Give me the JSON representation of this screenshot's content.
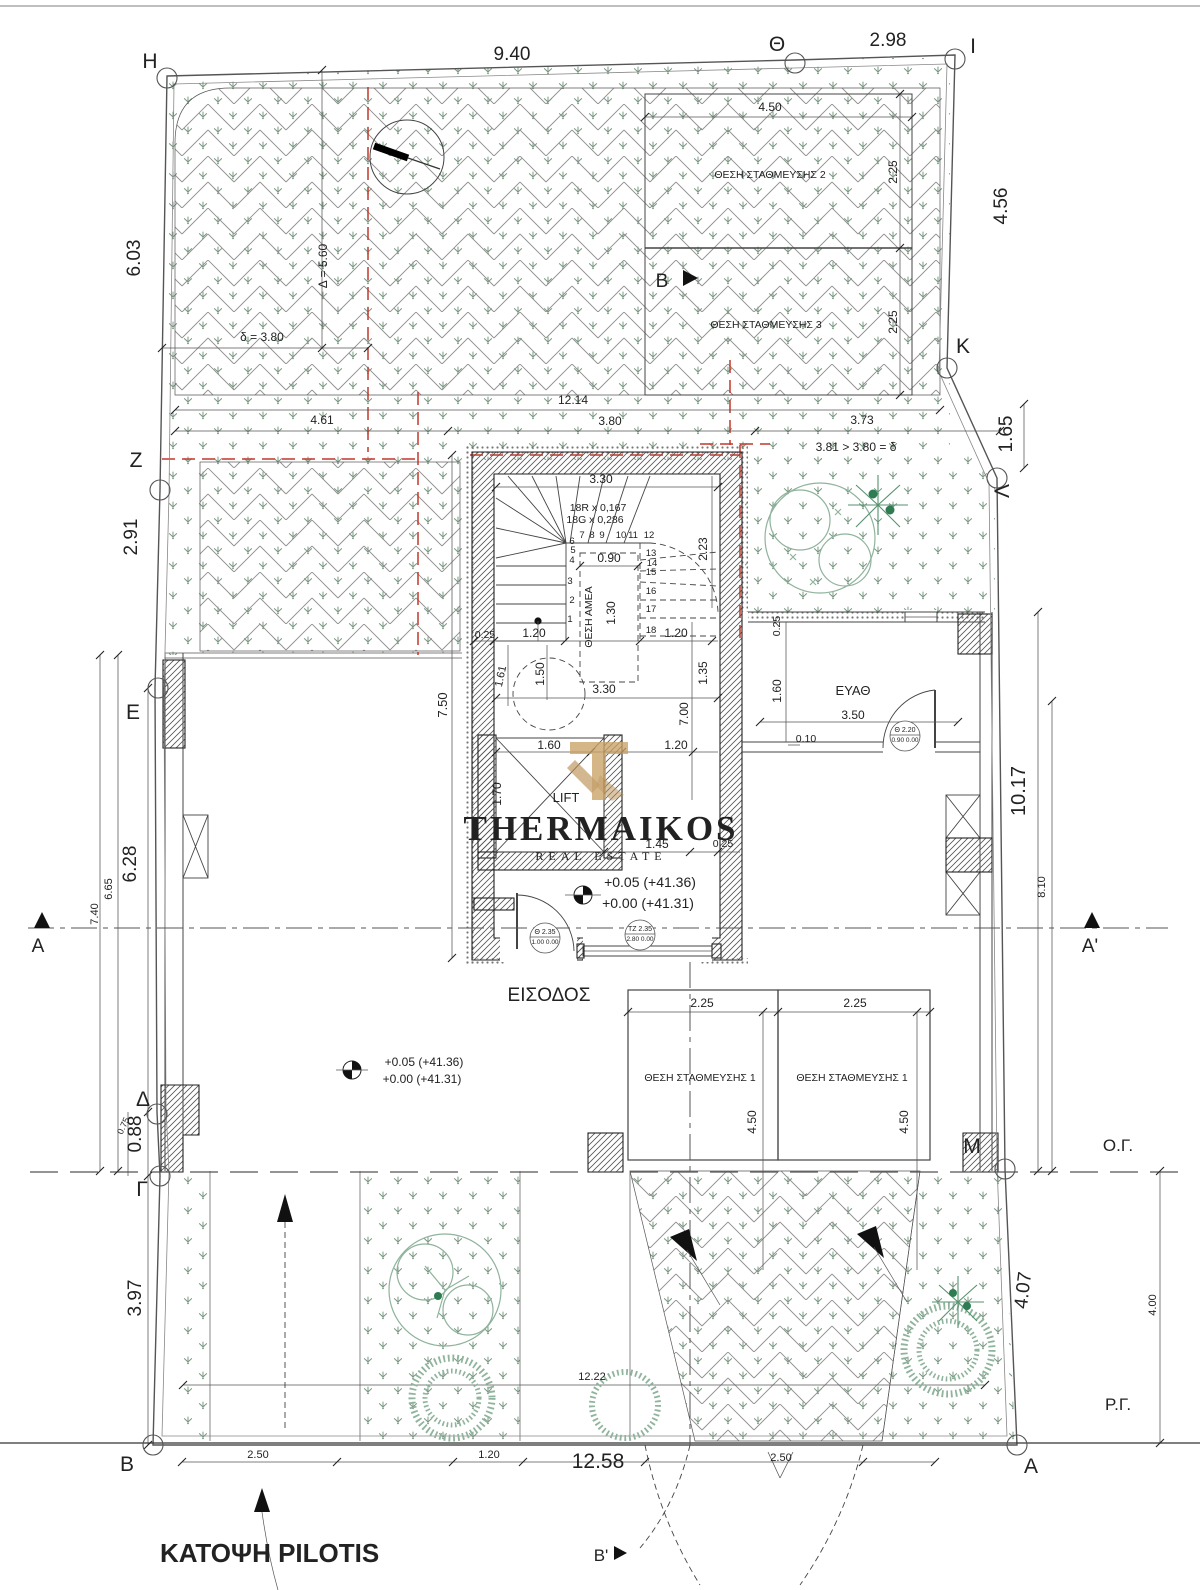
{
  "drawing": {
    "title": "ΚΑΤΟΨΗ PILOTIS",
    "entrance_label": "ΕΙΣΟΔΟΣ",
    "utility_room_label": "ΕΥΑΘ",
    "lift_label": "LIFT",
    "disabled_spot_label": "ΘΕΣΗ ΑΜΕΑ",
    "stair_note_risers": "18R x 0,167",
    "stair_note_goings": "18G x 0,286",
    "levels": [
      "+0.05 (+41.36)",
      "+0.00 (+41.31)"
    ],
    "building_line_label": "Ο.Γ.",
    "street_line_label": "Ρ.Γ."
  },
  "watermark": {
    "name": "THERMAIKOS",
    "tagline": "REAL ESTATE"
  },
  "colors": {
    "red": "#c0392b",
    "grass": "#76957f",
    "hatch": "#8f8f8f",
    "tree": "#8fb39c",
    "tree_dark": "#2e7d52",
    "fir": "#57916f",
    "gold": "#c9a063",
    "gold2": "#b98f53",
    "wm": "#8c8c8c",
    "wm2": "#ababab"
  },
  "markers": [
    {
      "id": "H",
      "x": 167,
      "y": 78
    },
    {
      "id": "Theta",
      "x": 795,
      "y": 63
    },
    {
      "id": "I",
      "x": 955,
      "y": 59
    },
    {
      "id": "K",
      "x": 947,
      "y": 368
    },
    {
      "id": "Lambda",
      "x": 997,
      "y": 478
    },
    {
      "id": "Z",
      "x": 160,
      "y": 490
    },
    {
      "id": "E",
      "x": 158,
      "y": 688
    },
    {
      "id": "Delta",
      "x": 157,
      "y": 1114
    },
    {
      "id": "Gamma",
      "x": 160,
      "y": 1176
    },
    {
      "id": "B",
      "x": 153,
      "y": 1445
    },
    {
      "id": "M",
      "x": 1005,
      "y": 1169
    },
    {
      "id": "A",
      "x": 1017,
      "y": 1445
    }
  ],
  "texts": [
    {
      "t": "H",
      "x": 150,
      "y": 68,
      "s": 21,
      "n": "marker-H"
    },
    {
      "t": "Θ",
      "x": 777,
      "y": 51,
      "s": 21,
      "n": "marker-theta"
    },
    {
      "t": "I",
      "x": 973,
      "y": 53,
      "s": 21,
      "n": "marker-I"
    },
    {
      "t": "K",
      "x": 963,
      "y": 353,
      "s": 21,
      "n": "marker-K"
    },
    {
      "t": "Λ",
      "x": 1009,
      "y": 491,
      "s": 21,
      "r": -90,
      "n": "marker-lambda"
    },
    {
      "t": "Z",
      "x": 136,
      "y": 467,
      "s": 21,
      "n": "marker-Z"
    },
    {
      "t": "E",
      "x": 133,
      "y": 719,
      "s": 21,
      "n": "marker-E"
    },
    {
      "t": "Δ",
      "x": 143,
      "y": 1106,
      "s": 21,
      "n": "marker-delta"
    },
    {
      "t": "Γ",
      "x": 142,
      "y": 1196,
      "s": 21,
      "n": "marker-gamma"
    },
    {
      "t": "B",
      "x": 127,
      "y": 1471,
      "s": 21,
      "n": "marker-B"
    },
    {
      "t": "M",
      "x": 972,
      "y": 1153,
      "s": 21,
      "n": "marker-M"
    },
    {
      "t": "A",
      "x": 1031,
      "y": 1473,
      "s": 21,
      "n": "marker-A"
    },
    {
      "t": "A",
      "x": 38,
      "y": 952,
      "s": 19,
      "n": "section-label-A"
    },
    {
      "t": "A'",
      "x": 1090,
      "y": 952,
      "s": 19,
      "n": "section-label-A2"
    },
    {
      "t": "B",
      "x": 662,
      "y": 287,
      "s": 19,
      "n": "section-label-B"
    },
    {
      "t": "Β'",
      "x": 601,
      "y": 1561,
      "s": 17,
      "n": "section-label-B2"
    },
    {
      "t": "9.40",
      "x": 512,
      "y": 60,
      "s": 19
    },
    {
      "t": "2.98",
      "x": 888,
      "y": 46,
      "s": 19
    },
    {
      "t": "6.03",
      "x": 140,
      "y": 258,
      "s": 19,
      "r": -90
    },
    {
      "t": "4.56",
      "x": 1007,
      "y": 206,
      "s": 19,
      "r": -90
    },
    {
      "t": "1.65",
      "x": 1012,
      "y": 434,
      "s": 19,
      "r": -90
    },
    {
      "t": "2.91",
      "x": 137,
      "y": 537,
      "s": 19,
      "r": -90
    },
    {
      "t": "6.28",
      "x": 136,
      "y": 864,
      "s": 19,
      "r": -90
    },
    {
      "t": "10.17",
      "x": 1025,
      "y": 791,
      "s": 20,
      "r": -90
    },
    {
      "t": "0.88",
      "x": 141,
      "y": 1134,
      "s": 19,
      "r": -90
    },
    {
      "t": "3.97",
      "x": 141,
      "y": 1298,
      "s": 19,
      "r": -90
    },
    {
      "t": "4.07",
      "x": 1029,
      "y": 1291,
      "s": 19,
      "r": -83
    },
    {
      "t": "12.58",
      "x": 598,
      "y": 1468,
      "s": 21
    },
    {
      "t": "6.65",
      "x": 112,
      "y": 889,
      "s": 11,
      "r": -90
    },
    {
      "t": "7.40",
      "x": 98,
      "y": 914,
      "s": 11,
      "r": -90
    },
    {
      "t": "0.75",
      "x": 126,
      "y": 1127,
      "s": 9,
      "r": -65
    },
    {
      "t": "8.10",
      "x": 1045,
      "y": 887,
      "s": 11,
      "r": -90
    },
    {
      "t": "4.00",
      "x": 1156,
      "y": 1305,
      "s": 11,
      "r": -90
    },
    {
      "t": "Ο.Γ.",
      "x": 1118,
      "y": 1151,
      "s": 17,
      "n": "building-line-label"
    },
    {
      "t": "Ρ.Γ.",
      "x": 1118,
      "y": 1410,
      "s": 17,
      "n": "street-line-label"
    },
    {
      "t": "4.50",
      "x": 770,
      "y": 111,
      "s": 12
    },
    {
      "t": "2.25",
      "x": 897,
      "y": 172,
      "s": 12,
      "r": -90
    },
    {
      "t": "2.25",
      "x": 897,
      "y": 322,
      "s": 12,
      "r": -90
    },
    {
      "t": "ΘΕΣΗ ΣΤΑΘΜΕΥΣΗΣ 2",
      "x": 770,
      "y": 178,
      "s": 10.5,
      "n": "parking-2-label"
    },
    {
      "t": "ΘΕΣΗ ΣΤΑΘΜΕΥΣΗΣ 3",
      "x": 766,
      "y": 328,
      "s": 10.5,
      "n": "parking-3-label"
    },
    {
      "t": "δ = 3.80",
      "x": 262,
      "y": 341,
      "s": 12
    },
    {
      "t": "Δ = 5.60",
      "x": 327,
      "y": 266,
      "s": 12,
      "r": -90
    },
    {
      "t": "12.14",
      "x": 573,
      "y": 404,
      "s": 12
    },
    {
      "t": "4.61",
      "x": 322,
      "y": 424,
      "s": 12
    },
    {
      "t": "3.80",
      "x": 610,
      "y": 425,
      "s": 12
    },
    {
      "t": "3.73",
      "x": 862,
      "y": 424,
      "s": 12
    },
    {
      "t": "3.81 > 3.80 = δ",
      "x": 856,
      "y": 451,
      "s": 12
    },
    {
      "t": "3.30",
      "x": 601,
      "y": 483,
      "s": 12
    },
    {
      "t": "18R x 0,167",
      "x": 598,
      "y": 511,
      "s": 10.5,
      "n": "stair-note-risers"
    },
    {
      "t": "18G x 0,286",
      "x": 595,
      "y": 523,
      "s": 10.5,
      "n": "stair-note-goings"
    },
    {
      "t": "0.90",
      "x": 609,
      "y": 562,
      "s": 12
    },
    {
      "t": "ΘΕΣΗ ΑΜΕΑ",
      "x": 592,
      "y": 617,
      "s": 10.5,
      "r": -90,
      "n": "disabled-spot-label"
    },
    {
      "t": "1.30",
      "x": 615,
      "y": 613,
      "s": 12,
      "r": -90
    },
    {
      "t": "2.23",
      "x": 707,
      "y": 549,
      "s": 12,
      "r": -90
    },
    {
      "t": "0.25",
      "x": 485,
      "y": 638,
      "s": 10.5
    },
    {
      "t": "1.20",
      "x": 534,
      "y": 637,
      "s": 12
    },
    {
      "t": "1.20",
      "x": 676,
      "y": 637,
      "s": 12
    },
    {
      "t": "1.61",
      "x": 504,
      "y": 677,
      "s": 11,
      "r": -78
    },
    {
      "t": "1.50",
      "x": 544,
      "y": 674,
      "s": 12,
      "r": -90
    },
    {
      "t": "3.30",
      "x": 604,
      "y": 693,
      "s": 12
    },
    {
      "t": "7.00",
      "x": 688,
      "y": 714,
      "s": 12,
      "r": -90
    },
    {
      "t": "1.35",
      "x": 707,
      "y": 673,
      "s": 12,
      "r": -90
    },
    {
      "t": "7.50",
      "x": 447,
      "y": 705,
      "s": 13,
      "r": -90
    },
    {
      "t": "1",
      "x": 570,
      "y": 622,
      "s": 9.5
    },
    {
      "t": "2",
      "x": 572,
      "y": 603,
      "s": 9.5
    },
    {
      "t": "3",
      "x": 570,
      "y": 584,
      "s": 9.5
    },
    {
      "t": "4",
      "x": 572,
      "y": 563,
      "s": 9.5
    },
    {
      "t": "5",
      "x": 573,
      "y": 553,
      "s": 9.5
    },
    {
      "t": "6",
      "x": 572,
      "y": 544,
      "s": 9.5
    },
    {
      "t": "7",
      "x": 582,
      "y": 538,
      "s": 9.5
    },
    {
      "t": "8",
      "x": 592,
      "y": 538,
      "s": 9.5
    },
    {
      "t": "9",
      "x": 602,
      "y": 538,
      "s": 9.5
    },
    {
      "t": "10",
      "x": 621,
      "y": 538,
      "s": 9.5
    },
    {
      "t": "11",
      "x": 633,
      "y": 538,
      "s": 9.5
    },
    {
      "t": "12",
      "x": 649,
      "y": 538,
      "s": 9.5
    },
    {
      "t": "13",
      "x": 651,
      "y": 556,
      "s": 9.5
    },
    {
      "t": "14",
      "x": 652,
      "y": 566,
      "s": 9.5
    },
    {
      "t": "15",
      "x": 651,
      "y": 575,
      "s": 9.5
    },
    {
      "t": "16",
      "x": 651,
      "y": 594,
      "s": 9.5
    },
    {
      "t": "17",
      "x": 651,
      "y": 612,
      "s": 9.5
    },
    {
      "t": "18",
      "x": 651,
      "y": 633,
      "s": 9.5
    },
    {
      "t": "1.60",
      "x": 549,
      "y": 749,
      "s": 12
    },
    {
      "t": "1.20",
      "x": 676,
      "y": 749,
      "s": 12
    },
    {
      "t": "1.70",
      "x": 501,
      "y": 794,
      "s": 12,
      "r": -90
    },
    {
      "t": "LIFT",
      "x": 566,
      "y": 802,
      "s": 13,
      "n": "lift-label"
    },
    {
      "t": "1.45",
      "x": 657,
      "y": 848,
      "s": 12
    },
    {
      "t": "0.25",
      "x": 723,
      "y": 847,
      "s": 10.5
    },
    {
      "t": "+0.05 (+41.36)",
      "x": 650,
      "y": 887,
      "s": 14,
      "n": "level-upper"
    },
    {
      "t": "+0.00 (+41.31)",
      "x": 648,
      "y": 908,
      "s": 14,
      "n": "level-lower"
    },
    {
      "t": "ΕΙΣΟΔΟΣ",
      "x": 549,
      "y": 1001,
      "s": 19,
      "n": "entrance-label"
    },
    {
      "t": "0.25",
      "x": 780,
      "y": 626,
      "s": 10.5,
      "r": -90
    },
    {
      "t": "1.60",
      "x": 781,
      "y": 691,
      "s": 12,
      "r": -90
    },
    {
      "t": "ΕΥΑΘ",
      "x": 853,
      "y": 695,
      "s": 13,
      "n": "utility-room-label"
    },
    {
      "t": "3.50",
      "x": 853,
      "y": 719,
      "s": 12
    },
    {
      "t": "0.10",
      "x": 806,
      "y": 742,
      "s": 10.5
    },
    {
      "t": "+0.05 (+41.36)",
      "x": 424,
      "y": 1066,
      "s": 12,
      "n": "level-upper-2"
    },
    {
      "t": "+0.00 (+41.31)",
      "x": 422,
      "y": 1083,
      "s": 12,
      "n": "level-lower-2"
    },
    {
      "t": "2.25",
      "x": 702,
      "y": 1007,
      "s": 12
    },
    {
      "t": "2.25",
      "x": 855,
      "y": 1007,
      "s": 12
    },
    {
      "t": "ΘΕΣΗ ΣΤΑΘΜΕΥΣΗΣ 1",
      "x": 700,
      "y": 1081,
      "s": 10.5,
      "n": "parking-1a-label"
    },
    {
      "t": "ΘΕΣΗ ΣΤΑΘΜΕΥΣΗΣ 1",
      "x": 852,
      "y": 1081,
      "s": 10.5,
      "n": "parking-1b-label"
    },
    {
      "t": "4.50",
      "x": 756,
      "y": 1122,
      "s": 12,
      "r": -90
    },
    {
      "t": "4.50",
      "x": 908,
      "y": 1122,
      "s": 12,
      "r": -90
    },
    {
      "t": "12.22",
      "x": 592,
      "y": 1380,
      "s": 11
    },
    {
      "t": "2.50",
      "x": 258,
      "y": 1458,
      "s": 11
    },
    {
      "t": "1.20",
      "x": 489,
      "y": 1458,
      "s": 11
    },
    {
      "t": "2.50",
      "x": 781,
      "y": 1461,
      "s": 11
    },
    {
      "t": "ΚΑΤΟΨΗ PILOTIS",
      "x": 160,
      "y": 1562,
      "s": 26,
      "w": 700,
      "a": "start",
      "n": "drawing-title"
    },
    {
      "t": "Θ  2.35",
      "x": 545,
      "y": 934,
      "s": 7,
      "n": "door-tag-1"
    },
    {
      "t": "1.00 0.00",
      "x": 545,
      "y": 944,
      "s": 6.5,
      "n": "door-tag-1b"
    },
    {
      "t": "ΤΖ 2.35",
      "x": 640,
      "y": 931,
      "s": 7,
      "n": "door-tag-2"
    },
    {
      "t": "2.80 0.00",
      "x": 640,
      "y": 941,
      "s": 6.5,
      "n": "door-tag-2b"
    },
    {
      "t": "Θ  2.20",
      "x": 905,
      "y": 732,
      "s": 7,
      "n": "door-tag-3"
    },
    {
      "t": "0.90 0.00",
      "x": 905,
      "y": 742,
      "s": 6.5,
      "n": "door-tag-3b"
    },
    {
      "t": "THERMAIKOS",
      "x": 601,
      "y": 840,
      "s": 35,
      "f": "serif",
      "w": 700,
      "c": "wm",
      "ls": 3,
      "n": "watermark-name"
    },
    {
      "t": "REAL ESTATE",
      "x": 601,
      "y": 860,
      "s": 12,
      "f": "serif",
      "c": "wm2",
      "ls": 5,
      "n": "watermark-tagline"
    }
  ]
}
